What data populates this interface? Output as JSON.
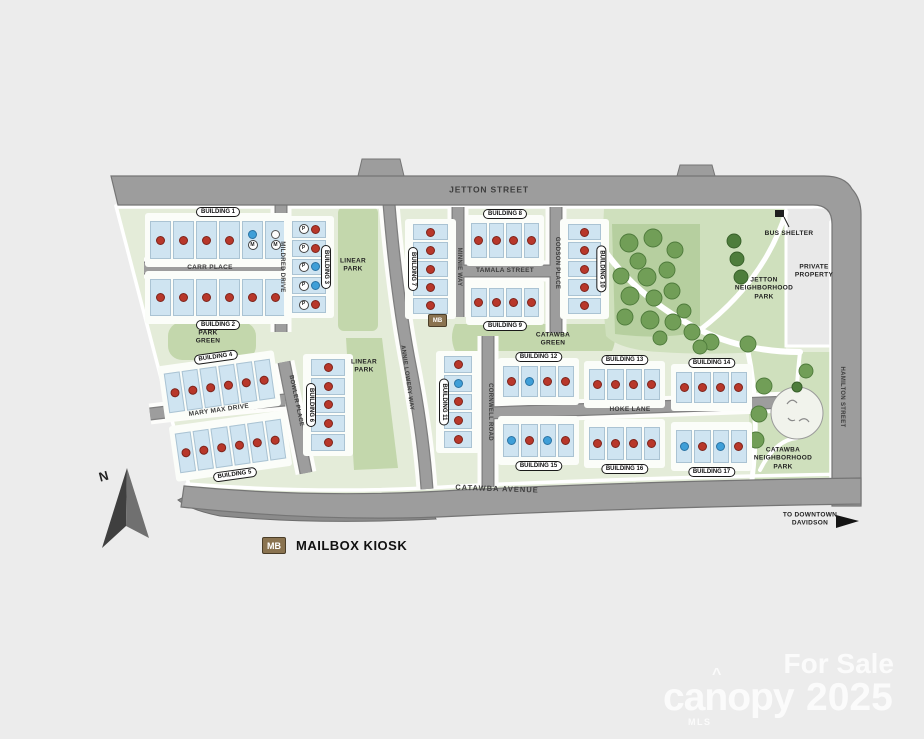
{
  "map": {
    "streets": {
      "jetton": "JETTON STREET",
      "carr": "CARR PLACE",
      "mildred": "MILDRED DRIVE",
      "mary_max": "MARY MAX DRIVE",
      "bowler": "BOWLER PLACE",
      "annie": "ANNIE LOWERY WAY",
      "minnie": "MINNIE WAY",
      "tamala": "TAMALA STREET",
      "godson": "GODSON PLACE",
      "cornwell": "CORNWELL ROAD",
      "hoke": "HOKE LANE",
      "catawba_ave": "CATAWBA AVENUE",
      "hamilton": "HAMILTON STREET"
    },
    "areas": {
      "park_green": "PARK\nGREEN",
      "linear_park_1": "LINEAR\nPARK",
      "linear_park_2": "LINEAR\nPARK",
      "catawba_green": "CATAWBA\nGREEN",
      "jetton_park": "JETTON\nNEIGHBORHOOD\nPARK",
      "catawba_park": "CATAWBA\nNEIGHBORHOOD\nPARK",
      "private_property": "PRIVATE\nPROPERTY"
    },
    "markers": {
      "mb": "MB",
      "bus_shelter": "BUS SHELTER",
      "to_downtown": "TO DOWNTOWN\nDAVIDSON",
      "north": "N"
    },
    "buildings": [
      {
        "name": "BUILDING 1",
        "units": [
          {
            "c": "red"
          },
          {
            "c": "red"
          },
          {
            "c": "red"
          },
          {
            "c": "red"
          },
          {
            "c": "blue",
            "m": "M"
          },
          {
            "c": "white",
            "m": "M"
          }
        ]
      },
      {
        "name": "BUILDING 2",
        "units": [
          {
            "c": "red"
          },
          {
            "c": "red"
          },
          {
            "c": "red"
          },
          {
            "c": "red"
          },
          {
            "c": "red"
          },
          {
            "c": "red"
          }
        ]
      },
      {
        "name": "BUILDING 3",
        "units": [
          {
            "c": "red",
            "p": "P"
          },
          {
            "c": "red",
            "p": "P"
          },
          {
            "c": "blue",
            "p": "P"
          },
          {
            "c": "blue",
            "p": "P"
          },
          {
            "c": "red",
            "p": "P"
          }
        ]
      },
      {
        "name": "BUILDING 4",
        "units": [
          {
            "c": "red"
          },
          {
            "c": "red"
          },
          {
            "c": "red"
          },
          {
            "c": "red"
          },
          {
            "c": "red"
          },
          {
            "c": "red"
          }
        ]
      },
      {
        "name": "BUILDING 5",
        "units": [
          {
            "c": "red"
          },
          {
            "c": "red"
          },
          {
            "c": "red"
          },
          {
            "c": "red"
          },
          {
            "c": "red"
          },
          {
            "c": "red"
          }
        ]
      },
      {
        "name": "BUILDING 6",
        "units": [
          {
            "c": "red"
          },
          {
            "c": "red"
          },
          {
            "c": "red"
          },
          {
            "c": "red"
          },
          {
            "c": "red"
          }
        ]
      },
      {
        "name": "BUILDING 7",
        "units": [
          {
            "c": "red"
          },
          {
            "c": "red"
          },
          {
            "c": "red"
          },
          {
            "c": "red"
          },
          {
            "c": "red"
          }
        ]
      },
      {
        "name": "BUILDING 8",
        "units": [
          {
            "c": "red"
          },
          {
            "c": "red"
          },
          {
            "c": "red"
          },
          {
            "c": "red"
          }
        ]
      },
      {
        "name": "BUILDING 9",
        "units": [
          {
            "c": "red"
          },
          {
            "c": "red"
          },
          {
            "c": "red"
          },
          {
            "c": "red"
          }
        ]
      },
      {
        "name": "BUILDING 10",
        "units": [
          {
            "c": "red"
          },
          {
            "c": "red"
          },
          {
            "c": "red"
          },
          {
            "c": "red"
          },
          {
            "c": "red"
          }
        ]
      },
      {
        "name": "BUILDING 11",
        "units": [
          {
            "c": "red"
          },
          {
            "c": "blue"
          },
          {
            "c": "red"
          },
          {
            "c": "red"
          },
          {
            "c": "red"
          }
        ]
      },
      {
        "name": "BUILDING 12",
        "units": [
          {
            "c": "red"
          },
          {
            "c": "blue"
          },
          {
            "c": "red"
          },
          {
            "c": "red"
          }
        ]
      },
      {
        "name": "BUILDING 13",
        "units": [
          {
            "c": "red"
          },
          {
            "c": "red"
          },
          {
            "c": "red"
          },
          {
            "c": "red"
          }
        ]
      },
      {
        "name": "BUILDING 14",
        "units": [
          {
            "c": "red"
          },
          {
            "c": "red"
          },
          {
            "c": "red"
          },
          {
            "c": "red"
          }
        ]
      },
      {
        "name": "BUILDING 15",
        "units": [
          {
            "c": "blue"
          },
          {
            "c": "red"
          },
          {
            "c": "blue"
          },
          {
            "c": "red"
          }
        ]
      },
      {
        "name": "BUILDING 16",
        "units": [
          {
            "c": "red"
          },
          {
            "c": "red"
          },
          {
            "c": "red"
          },
          {
            "c": "red"
          }
        ]
      },
      {
        "name": "BUILDING 17",
        "units": [
          {
            "c": "blue"
          },
          {
            "c": "red"
          },
          {
            "c": "blue"
          },
          {
            "c": "red"
          }
        ]
      }
    ]
  },
  "legend": {
    "mb": "MB",
    "mailbox": "MAILBOX KIOSK"
  },
  "watermark": {
    "for_sale": "For Sale",
    "brand": "canopy",
    "year": "2025",
    "mls": "MLS",
    "caret": "^"
  },
  "colors": {
    "unit_red": "#b8372a",
    "unit_blue": "#3f9fd8",
    "unit_white": "#fdfdfd",
    "building_blue": "#cfe4f1",
    "road_gray": "#9d9d9d",
    "site_green": "#e4ecd9",
    "park_green": "#c3d7ac",
    "mb_badge": "#8a7350",
    "watermark": "#ffffff"
  }
}
